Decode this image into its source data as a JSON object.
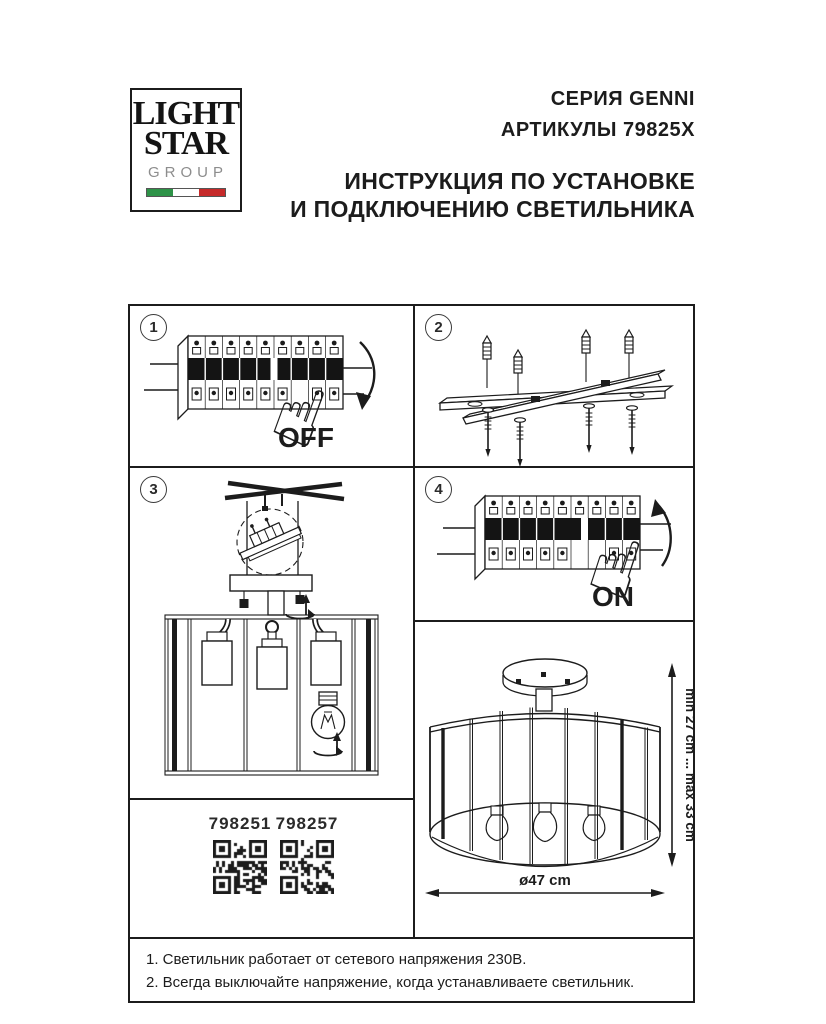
{
  "ink": "#1c1c1c",
  "logo": {
    "word1": "LIGHT",
    "word2": "STAR",
    "word3": "GROUP",
    "flag_green": "#2e9348",
    "flag_white": "#ffffff",
    "flag_red": "#c62a2a"
  },
  "header": {
    "series": "СЕРИЯ GENNI",
    "articles": "АРТИКУЛЫ 79825X",
    "title_line1": "ИНСТРУКЦИЯ ПО УСТАНОВКЕ",
    "title_line2": "И ПОДКЛЮЧЕНИЮ СВЕТИЛЬНИКА"
  },
  "steps": {
    "s1": "1",
    "s2": "2",
    "s3": "3",
    "s4": "4",
    "off_label": "OFF",
    "on_label": "ON"
  },
  "icons": {
    "pointing_hand": "☝"
  },
  "qr": {
    "left_article": "798251",
    "right_article": "798257"
  },
  "dims": {
    "height_range": "min 27 cm ... max 33 cm",
    "diameter": "ø47 cm"
  },
  "notes": {
    "line1": "1. Светильник работает от сетевого напряжения 230В.",
    "line2": "2. Всегда выключайте напряжение, когда устанавливаете светильник."
  }
}
